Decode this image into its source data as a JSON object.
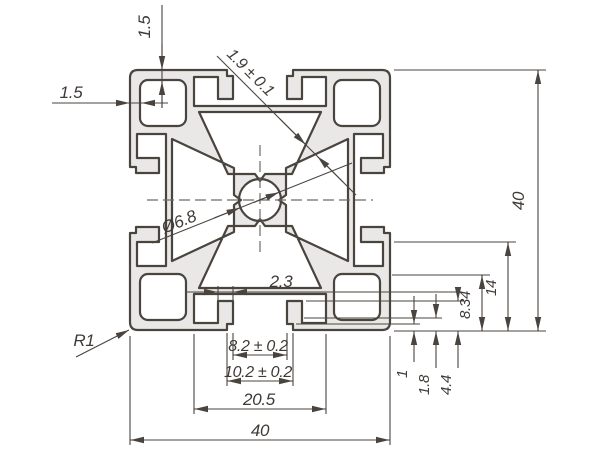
{
  "drawing": {
    "type": "technical-cross-section",
    "subject": "40x40 aluminium extrusion profile",
    "labels": {
      "wall_thickness_top": "1.5",
      "wall_thickness_left": "1.5",
      "web_thickness": "1.9 ± 0.1",
      "overall_height": "40",
      "overall_width": "40",
      "hole_diameter": "Ø6.8",
      "hook_wall": "2.3",
      "corner_radius": "R1",
      "slot_opening": "8.2 ± 0.2",
      "slot_step": "10.2 ± 0.2",
      "slot_cavity_width": "20.5",
      "step_depth": "1",
      "lip_depth": "1.8",
      "cavity_depth": "4.4",
      "hook_depth": "8.34",
      "cavity_height": "14"
    },
    "colors": {
      "body_fill": "#e9e8e6",
      "line": "#4a443f",
      "centerline": "#6f6b68",
      "background": "#ffffff"
    }
  }
}
